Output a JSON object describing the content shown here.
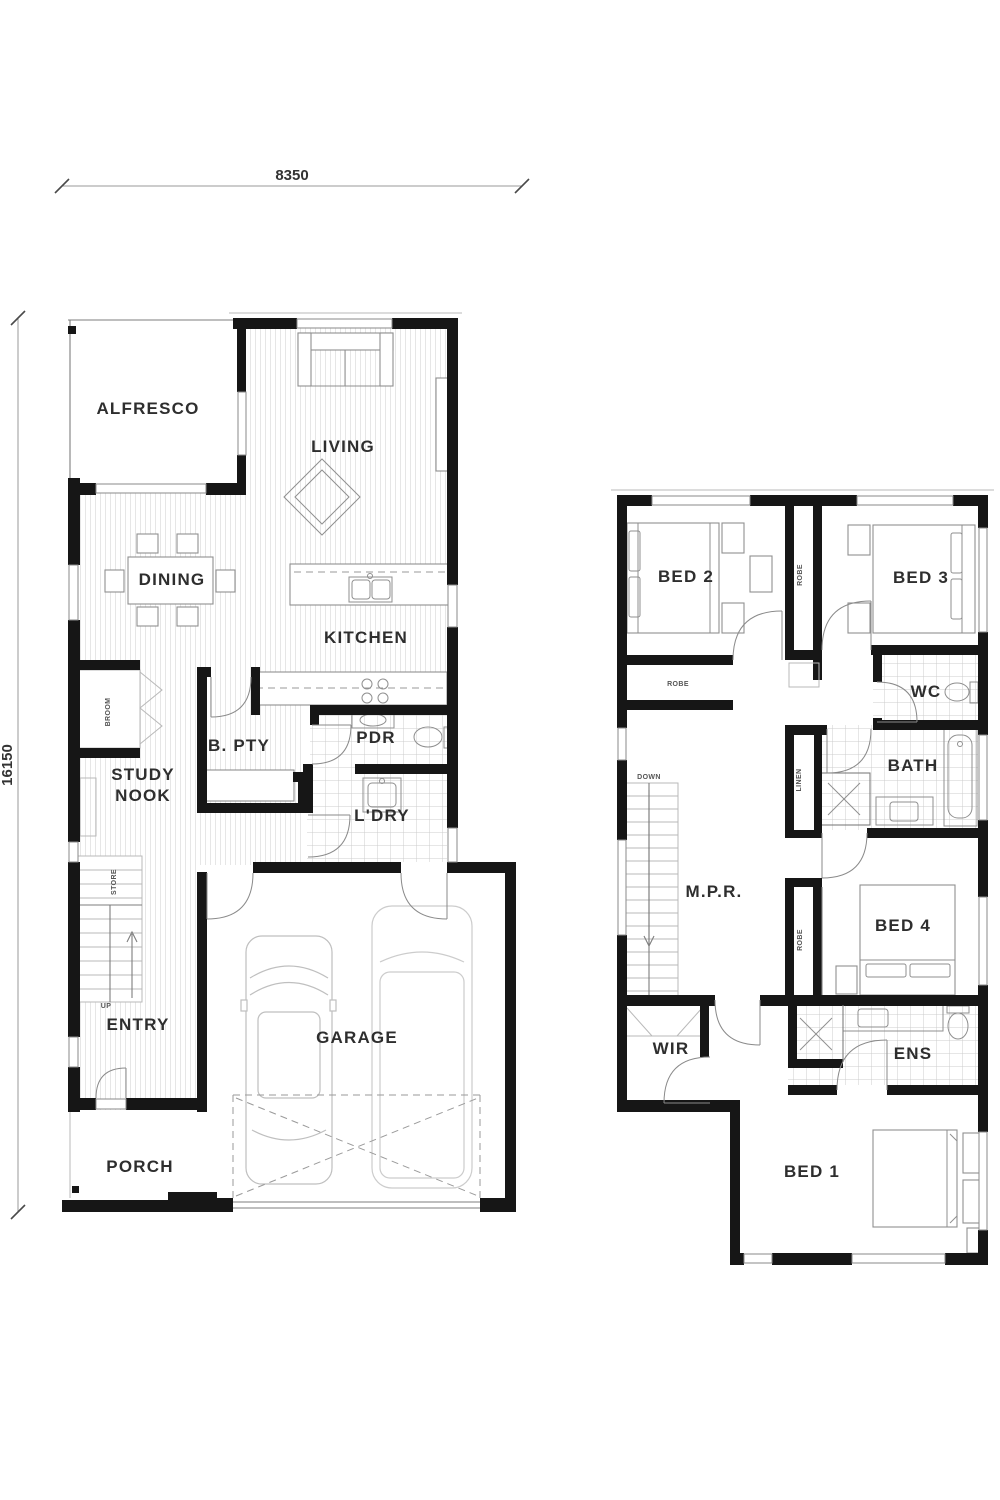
{
  "colors": {
    "wall": "#161616",
    "line": "#8a8a8a",
    "stripe": "#e4e4e4",
    "tile": "#c8c8c8",
    "text": "#2e2e2e"
  },
  "dimensions": {
    "top": "8350",
    "left": "16150"
  },
  "ground_floor": {
    "alfresco": "ALFRESCO",
    "living": "LIVING",
    "dining": "DINING",
    "kitchen": "KITCHEN",
    "study_line1": "STUDY",
    "study_line2": "NOOK",
    "butlers_pantry": "B. PTY",
    "powder": "PDR",
    "laundry": "L'DRY",
    "entry": "ENTRY",
    "garage": "GARAGE",
    "porch": "PORCH",
    "broom": "BROOM",
    "store": "STORE",
    "up": "UP"
  },
  "upper_floor": {
    "bed2": "BED 2",
    "bed3": "BED 3",
    "wc": "WC",
    "bath": "BATH",
    "mpr": "M.P.R.",
    "bed4": "BED 4",
    "wir": "WIR",
    "ens": "ENS",
    "bed1": "BED 1",
    "robe_bed2": "ROBE",
    "robe_hall": "ROBE",
    "robe_bed4": "ROBE",
    "linen": "LINEN",
    "down": "DOWN"
  }
}
